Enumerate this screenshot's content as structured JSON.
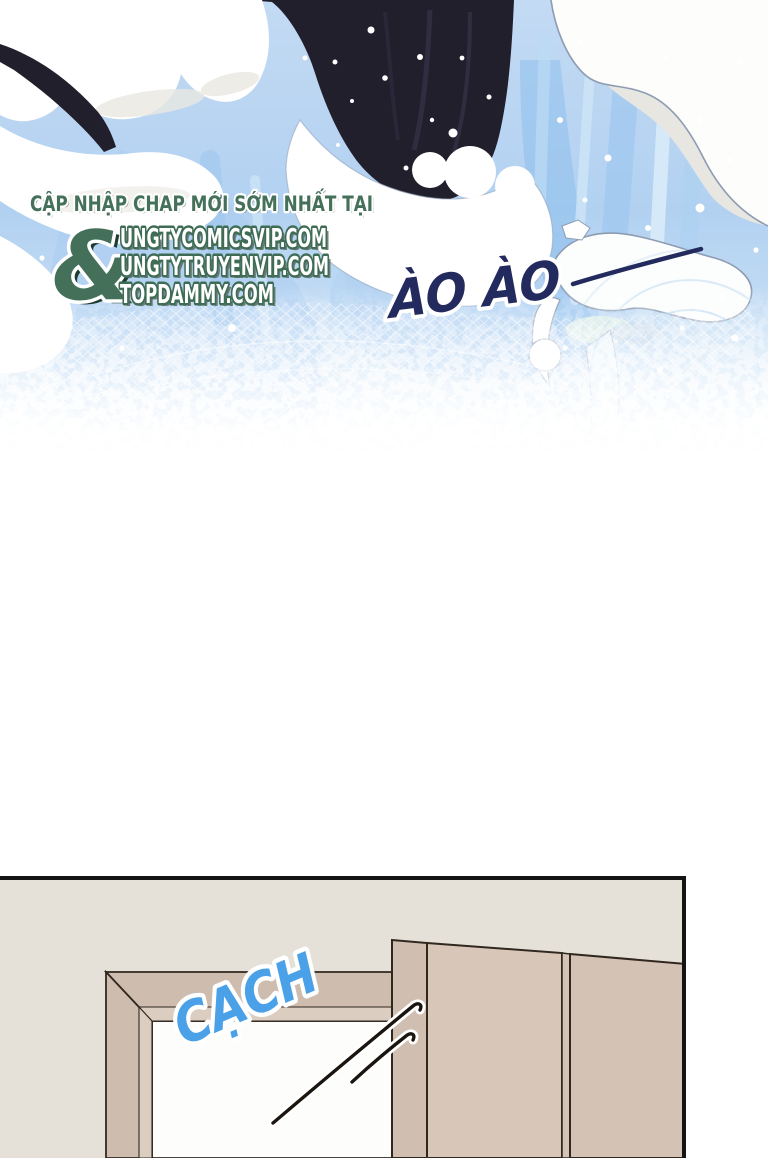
{
  "page": {
    "background": "#ffffff"
  },
  "art": {
    "watermark": {
      "tagline": "CẬP NHẬP CHAP MỚI SỚM NHẤT TẠI",
      "ampersand": "&",
      "sites": [
        "UNGTYCOMICSVIP.COM",
        "UNGTYTRUYENVIP.COM",
        "TOPDAMMY.COM"
      ],
      "text_green": "#45715a",
      "site_fill": "#ffffff",
      "site_outline": "#3e6c54"
    },
    "sfx_wave": {
      "text": "ÀO ÀO",
      "color": "#232a5e"
    },
    "palette": {
      "sky_blue": "#b6d4f2",
      "foam_white": "#ffffff",
      "foam_shadow": "#e9e7e1",
      "dark_hair": "#211f2c",
      "foam_edge": "#8d9cb2"
    }
  },
  "panel": {
    "sfx_door": {
      "text": "CẠCH",
      "color": "#4ba1e8"
    },
    "palette": {
      "wall": "#e6e1d8",
      "door_frame": "#cebcaf",
      "door": "#d8c6b9",
      "outline": "#30281f",
      "border": "#141414"
    }
  }
}
